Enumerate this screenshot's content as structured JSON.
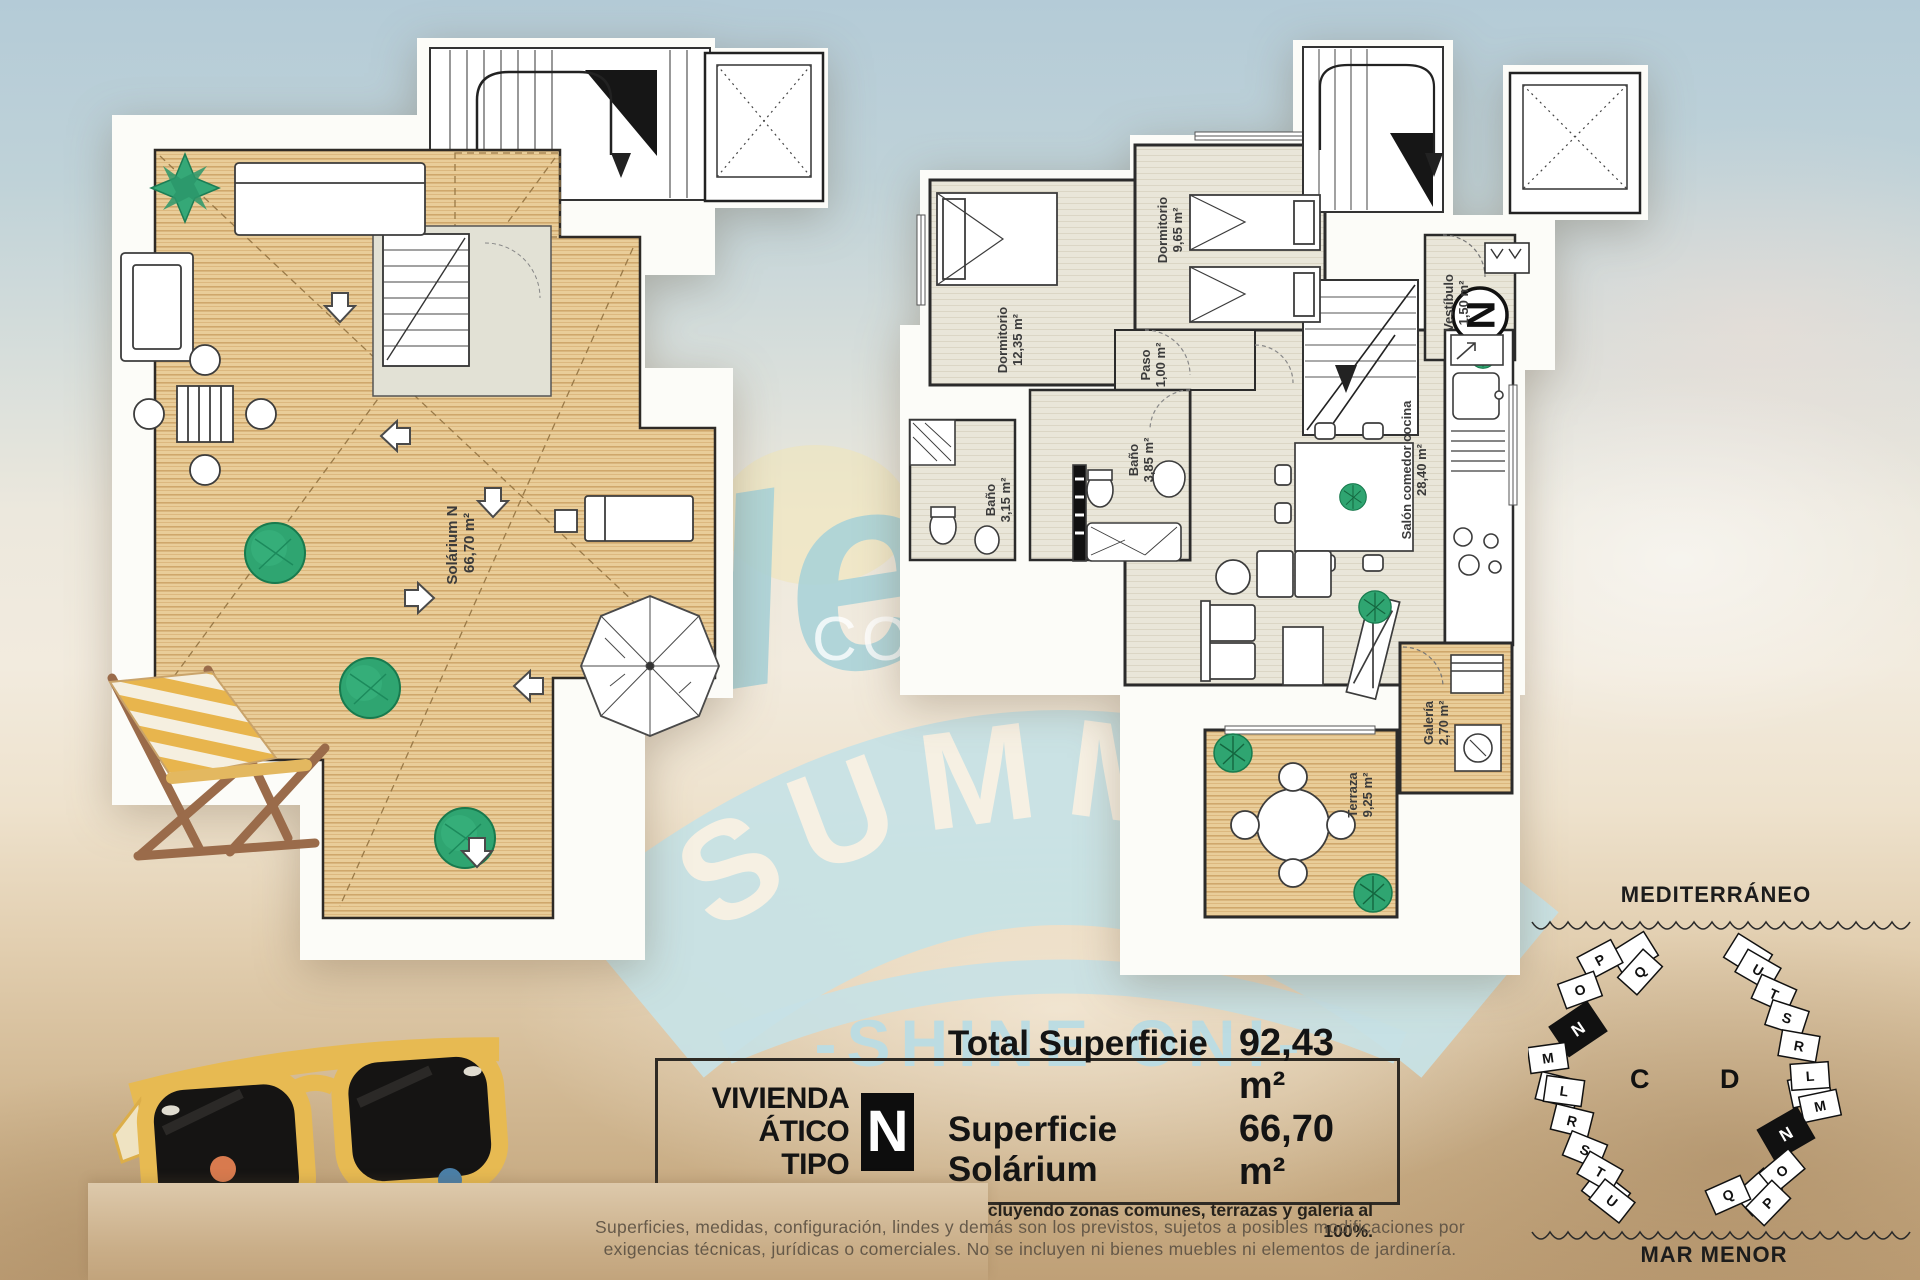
{
  "watermark": {
    "hello": "Hello",
    "summer": "SUMMER",
    "shine": "-SHINE ON!-",
    "brand_costa": "COSTA",
    "brand_group": "GROUP",
    "brand_estates": "ESTATES"
  },
  "left_plan": {
    "room_label": "Solárium N",
    "room_area": "66,70 m²"
  },
  "right_plan": {
    "compass_letter": "N",
    "rooms": {
      "dorm_a": {
        "label": "Dormitorio",
        "area": "12,35 m²"
      },
      "dorm_b": {
        "label": "Dormitorio",
        "area": "9,65 m²"
      },
      "paso": {
        "label": "Paso",
        "area": "1,00 m²"
      },
      "bano_a": {
        "label": "Baño",
        "area": "3,15 m²"
      },
      "bano_b": {
        "label": "Baño",
        "area": "3,85 m²"
      },
      "salon": {
        "label": "Salón comedor cocina",
        "area": "28,40 m²"
      },
      "vestibulo": {
        "label": "Vestíbulo",
        "area": "1,50 m²"
      },
      "galeria": {
        "label": "Galería",
        "area": "2,70 m²"
      },
      "terraza": {
        "label": "Terraza",
        "area": "9,25 m²"
      }
    }
  },
  "info_box": {
    "line1": "VIVIENDA",
    "line2": "ÁTICO TIPO",
    "type_letter": "N",
    "total_label": "Total Superficie",
    "total_value": "92,43 m²",
    "solarium_label": "Superficie Solárium",
    "solarium_value": "66,70 m²",
    "footnote": "* Incluyendo zonas comunes, terrazas y galería al 100%."
  },
  "disclaimer": {
    "line1": "Superficies, medidas, configuración, lindes y demás son los previstos, sujetos a posibles modificaciones por",
    "line2": "exigencias técnicas, jurídicas o comerciales. No se incluyen ni bienes muebles ni elementos de jardinería."
  },
  "site_map": {
    "sea_top": "MEDITERRÁNEO",
    "sea_bottom": "MAR MENOR",
    "building_c": {
      "label": "C",
      "units": [
        "P",
        "Q",
        "O",
        "N",
        "M",
        "L",
        "R",
        "S",
        "T",
        "U"
      ],
      "highlighted": "N"
    },
    "building_d": {
      "label": "D",
      "units": [
        "U",
        "T",
        "S",
        "R",
        "L",
        "M",
        "N",
        "O",
        "Q",
        "P"
      ],
      "highlighted": "N"
    }
  },
  "colors": {
    "badge_blue": "#c7e1e5",
    "wood": "#e7c893",
    "sand": "#cdb089",
    "highlight_unit": "#111111"
  }
}
